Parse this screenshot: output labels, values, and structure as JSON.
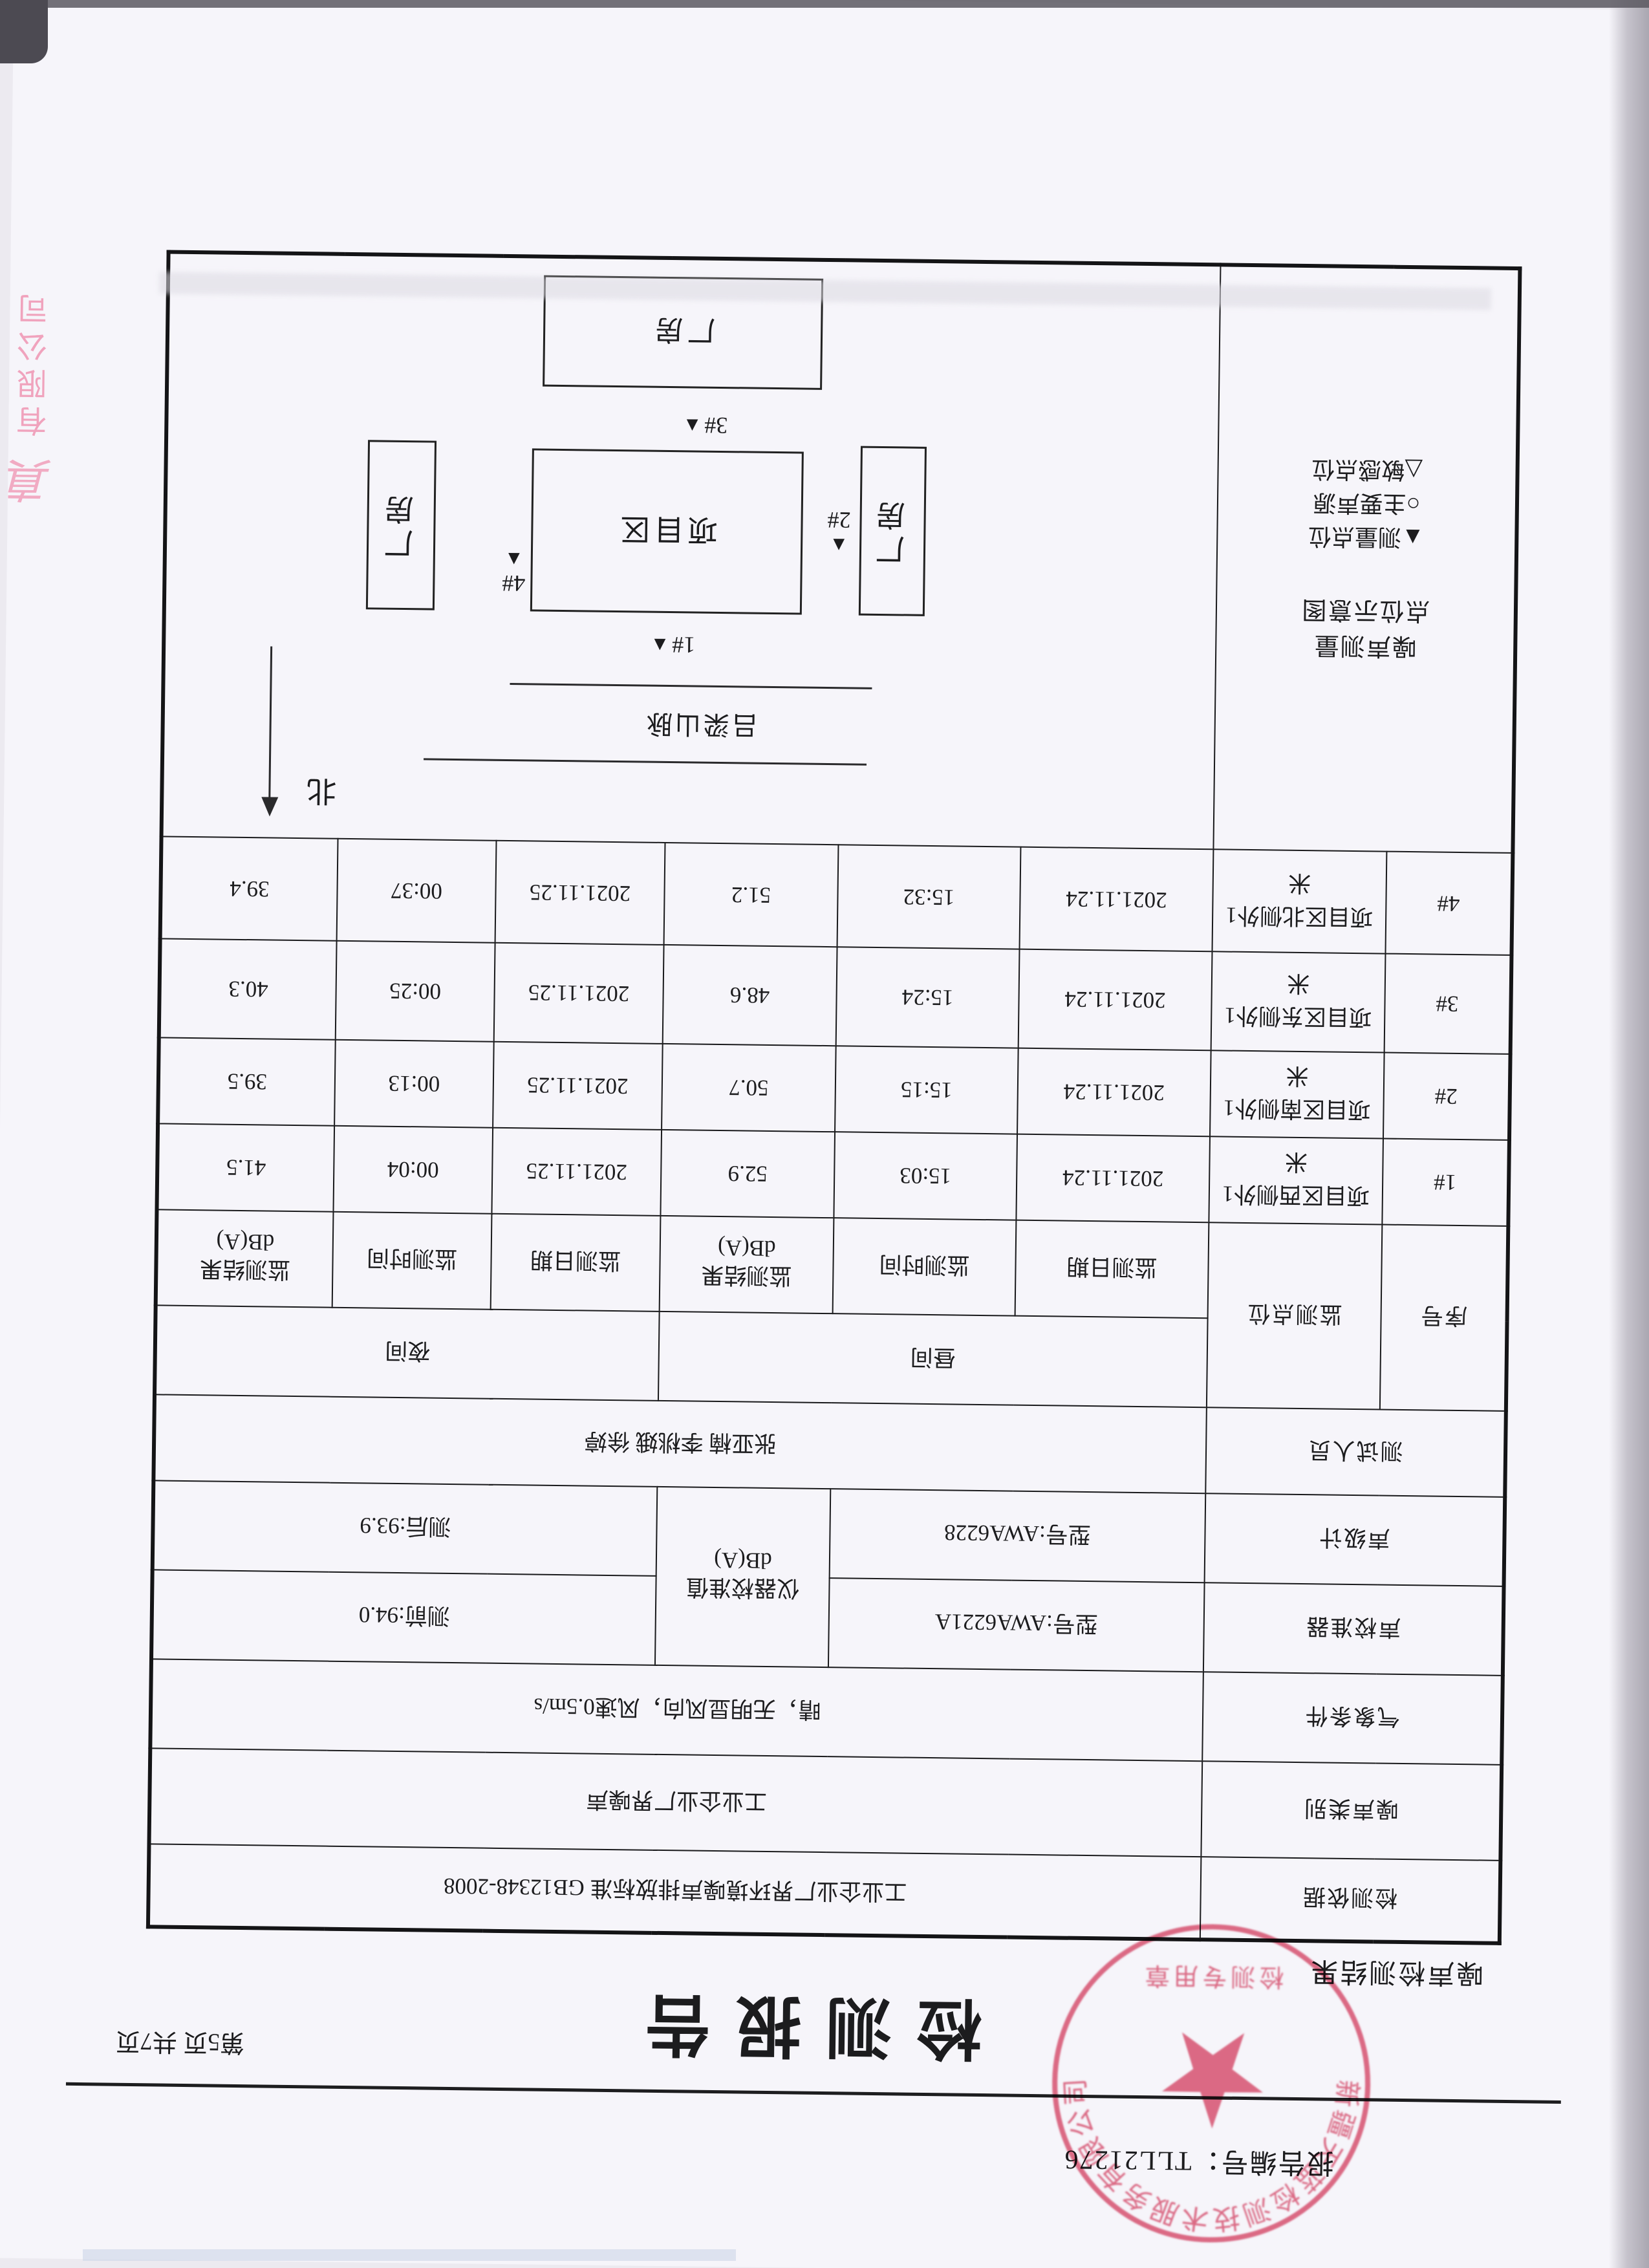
{
  "header": {
    "report_no": "报告编号：TLL21276",
    "title": "检测报告",
    "page_info": "第5页 共7页",
    "section": "噪声检测结果"
  },
  "info": {
    "basis_label": "检测依据",
    "basis_value": "工业企业厂界环境噪声排放标准  GB12348-2008",
    "type_label": "噪声类别",
    "type_value": "工业企业厂界噪声",
    "weather_label": "气象条件",
    "weather_value": "晴，无明显风向，风速0.5m/s",
    "calibrator_label": "声校准器",
    "calibrator_model": "型号:AWA6221A",
    "meter_label": "声级计",
    "meter_model": "型号:AWA6228",
    "cal_value_label": "仪器校准值\ndB(A)",
    "cal_before": "测前:94.0",
    "cal_after": "测后:93.9",
    "testers_label": "测试人员",
    "testers_value": "张亚楠  李桃娥  徐婷"
  },
  "table": {
    "seq": "序号",
    "point": "监测点位",
    "day": "昼间",
    "night": "夜间",
    "date": "监测日期",
    "time": "监测时间",
    "result": "监测结果\ndB(A)",
    "rows": [
      {
        "seq": "1#",
        "point": "项目区西侧外1米",
        "day_date": "2021.11.24",
        "day_time": "15:03",
        "day_result": "52.9",
        "night_date": "2021.11.25",
        "night_time": "00:04",
        "night_result": "41.5"
      },
      {
        "seq": "2#",
        "point": "项目区南侧外1米",
        "day_date": "2021.11.24",
        "day_time": "15:15",
        "day_result": "50.7",
        "night_date": "2021.11.25",
        "night_time": "00:13",
        "night_result": "39.5"
      },
      {
        "seq": "3#",
        "point": "项目区东侧外1米",
        "day_date": "2021.11.24",
        "day_time": "15:24",
        "day_result": "48.6",
        "night_date": "2021.11.25",
        "night_time": "00:25",
        "night_result": "40.3"
      },
      {
        "seq": "4#",
        "point": "项目区北侧外1米",
        "day_date": "2021.11.24",
        "day_time": "15:32",
        "day_result": "51.2",
        "night_date": "2021.11.25",
        "night_time": "00:37",
        "night_result": "39.4"
      }
    ]
  },
  "diagram": {
    "label": "噪声测量\n点位示意图",
    "legend": [
      "▲测量点位",
      "○主要声源",
      "△敏感点位"
    ],
    "north": "北",
    "mountain": "吕梁山脉",
    "project": "项目区",
    "factory": "厂房",
    "markers": {
      "m1": "1#",
      "m2": "2#",
      "m3": "3#",
      "m4": "4#"
    }
  },
  "stamps": {
    "seal_company": "新疆天蓝检测技术服务有限公司",
    "seal_type": "检测专用章",
    "edge_mark": "真",
    "edge_text": "有限公司"
  },
  "colors": {
    "seal_red": "#dd4d6c",
    "edge_pink": "#ef8fae",
    "paper": "#f6f5fa",
    "ink": "#1c1c1e"
  }
}
